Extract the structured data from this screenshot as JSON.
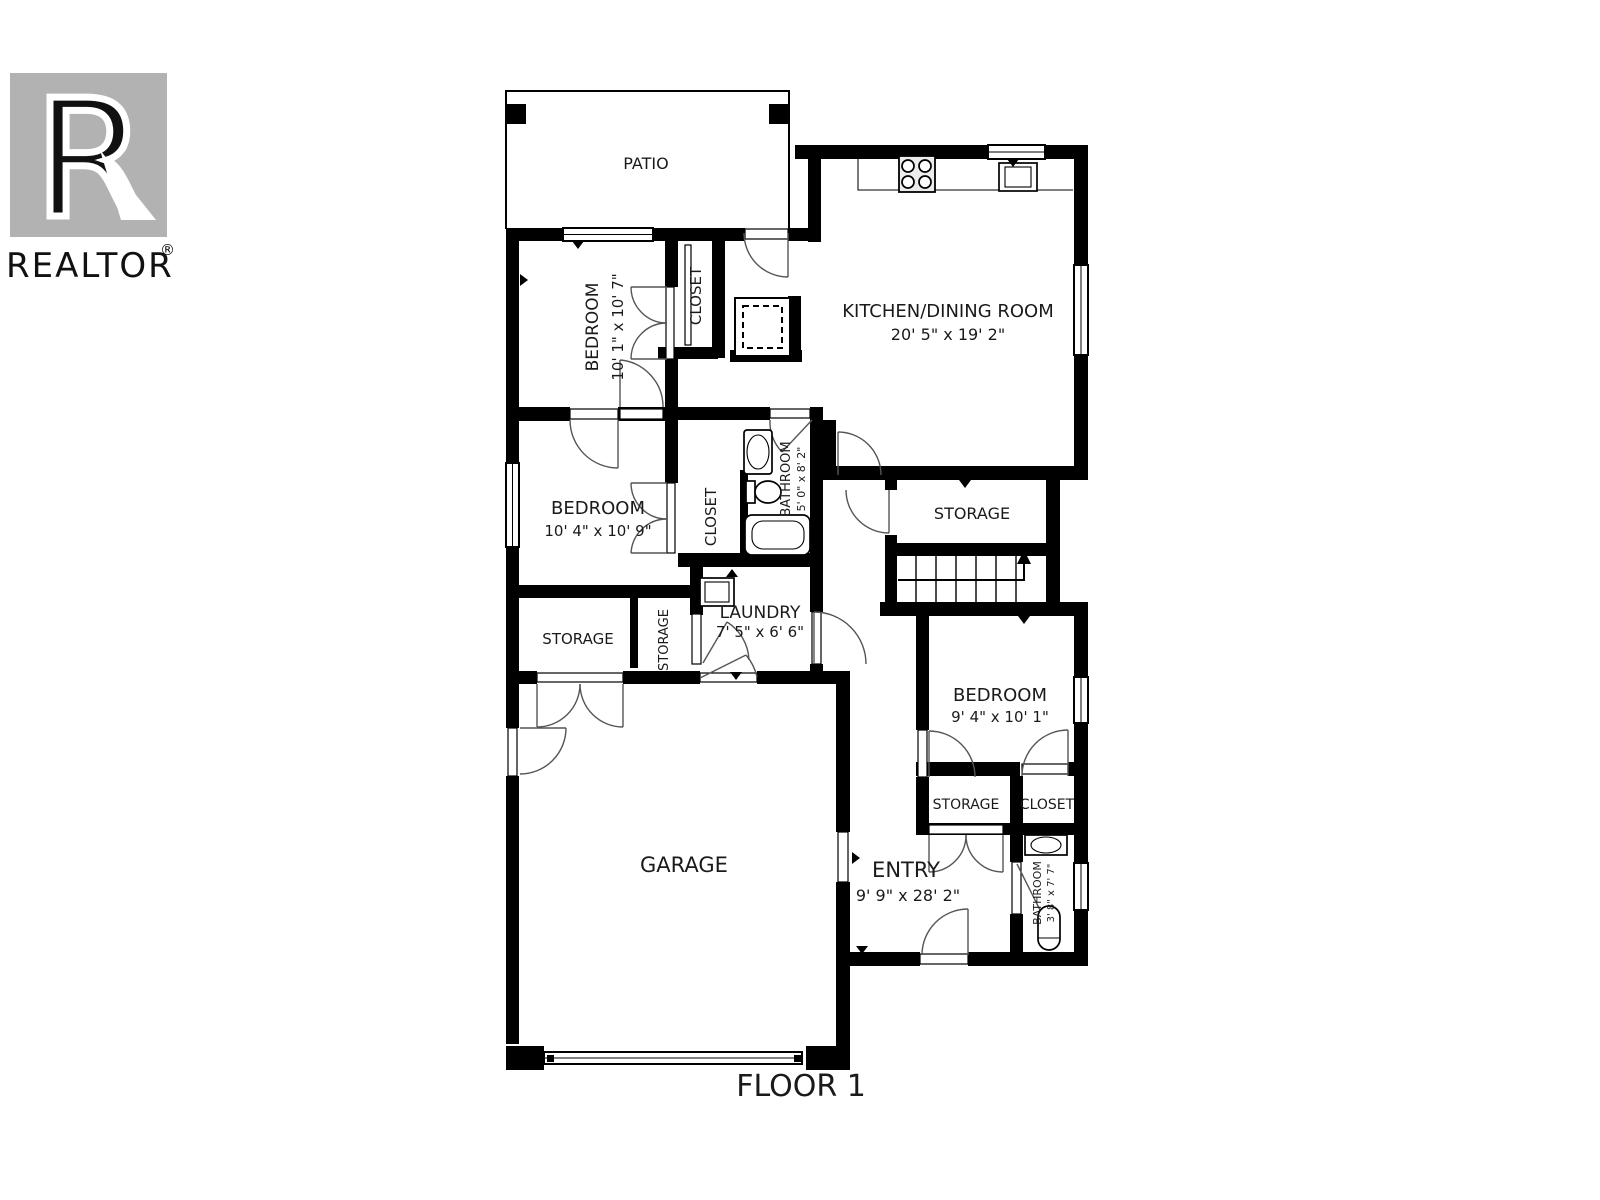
{
  "branding": {
    "logo_letter": "R",
    "logo_text": "REALTOR",
    "registered_symbol": "®"
  },
  "floor": {
    "label": "FLOOR 1"
  },
  "rooms": {
    "patio": {
      "label": "PATIO"
    },
    "bedroom_top": {
      "label": "BEDROOM",
      "dimensions": "10' 1\" x 10' 7\""
    },
    "closet_top": {
      "label": "CLOSET"
    },
    "kitchen_dining": {
      "label": "KITCHEN/DINING ROOM",
      "dimensions": "20' 5\" x 19' 2\""
    },
    "bedroom_middle": {
      "label": "BEDROOM",
      "dimensions": "10' 4\" x 10' 9\""
    },
    "closet_middle": {
      "label": "CLOSET"
    },
    "bathroom_main": {
      "label": "BATHROOM",
      "dimensions": "5' 0\" x 8' 2\""
    },
    "storage_hall": {
      "label": "STORAGE"
    },
    "storage_left": {
      "label": "STORAGE"
    },
    "storage_small": {
      "label": "STORAGE"
    },
    "laundry": {
      "label": "LAUNDRY",
      "dimensions": "7' 5\" x 6' 6\""
    },
    "bedroom_right": {
      "label": "BEDROOM",
      "dimensions": "9' 4\" x 10' 1\""
    },
    "storage_entry": {
      "label": "STORAGE"
    },
    "closet_entry": {
      "label": "CLOSET"
    },
    "bathroom_entry": {
      "label": "BATHROOM",
      "dimensions": "3' 8\" x 7' 7\""
    },
    "entry": {
      "label": "ENTRY",
      "dimensions": "9' 9\" x 28' 2\""
    },
    "garage": {
      "label": "GARAGE"
    }
  },
  "colors": {
    "walls": "#000000",
    "logo_gray": "#b2b2b2",
    "background": "#ffffff",
    "text": "#1a1a1a"
  }
}
